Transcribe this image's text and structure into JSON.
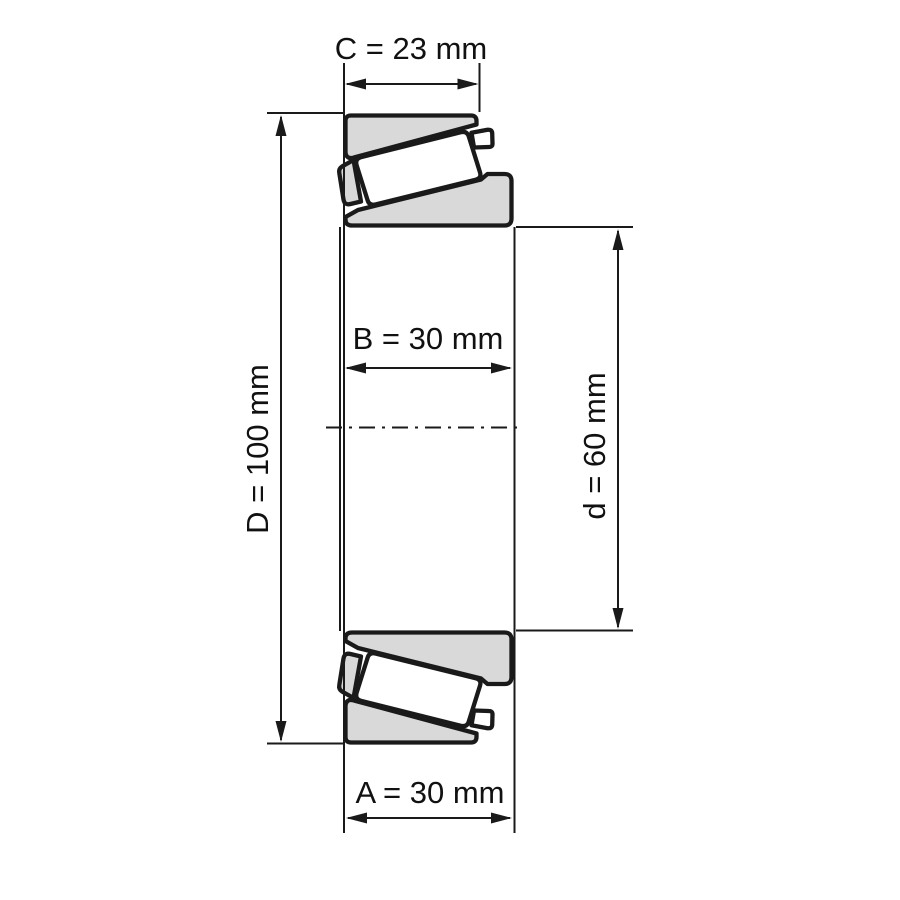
{
  "diagram": {
    "type": "tapered-roller-bearing-cross-section",
    "unit": "mm",
    "dimensions": {
      "C": {
        "name": "C",
        "value": 23,
        "label": "C = 23 mm"
      },
      "D": {
        "name": "D",
        "value": 100,
        "label": "D = 100 mm"
      },
      "B": {
        "name": "B",
        "value": 30,
        "label": "B = 30 mm"
      },
      "d": {
        "name": "d",
        "value": 60,
        "label": "d = 60 mm"
      },
      "A": {
        "name": "A",
        "value": 30,
        "label": "A = 30 mm"
      }
    },
    "colors": {
      "part_fill": "#d9d9d9",
      "roller_fill": "#ffffff",
      "outline": "#1a1a1a",
      "background": "#ffffff"
    }
  }
}
